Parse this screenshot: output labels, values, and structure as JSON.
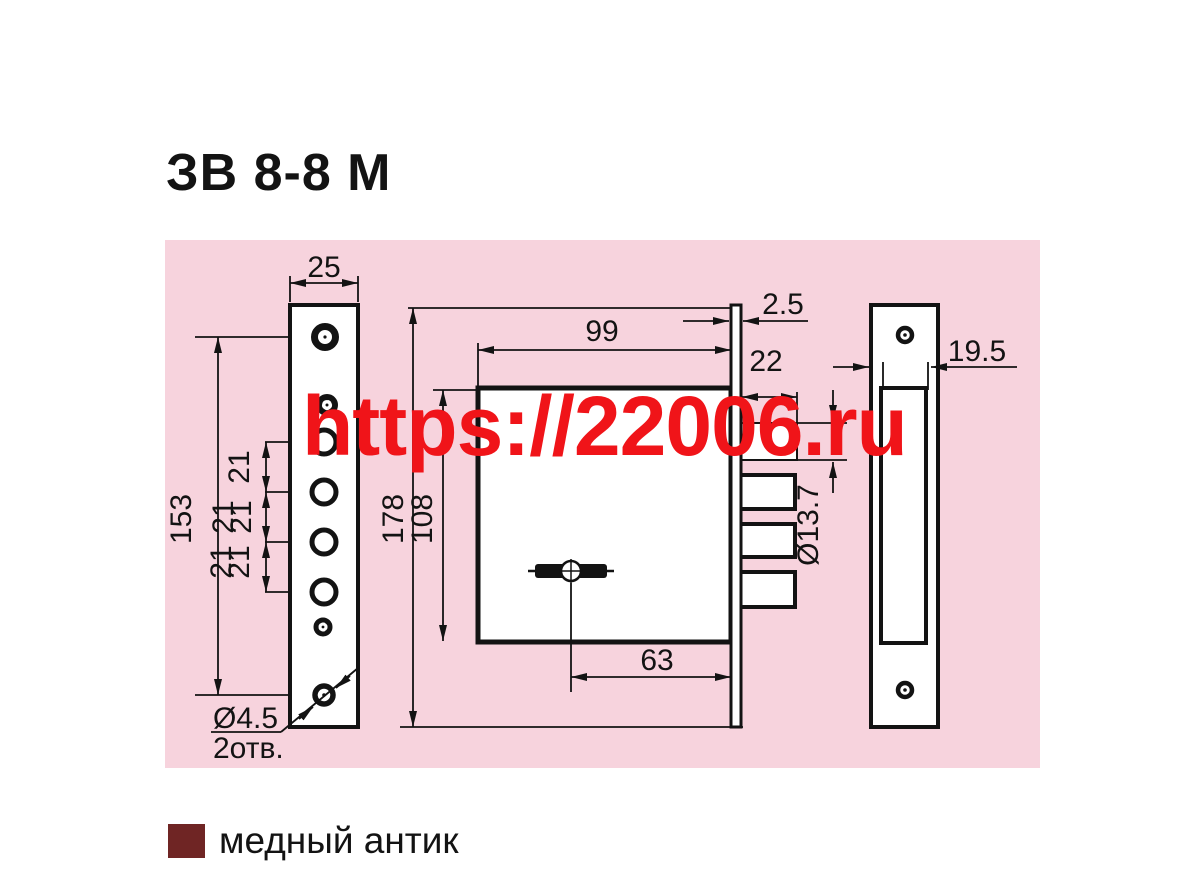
{
  "header": {
    "title": "ЗВ 8-8 М"
  },
  "watermark": {
    "text": "https://22006.ru",
    "color": "#f01419"
  },
  "drawing": {
    "panel_bg": "#f7d3dd",
    "line_color": "#131313",
    "dims": {
      "plate_width": "25",
      "plate_hole_span": "153",
      "pitch": [
        "21",
        "21",
        "21",
        "21",
        "21"
      ],
      "screw_hole_dia": "Ø4.5",
      "screw_hole_count": "2отв.",
      "body_width": "99",
      "face_thickness": "2.5",
      "bolt_throw": "22",
      "bolt_dia": "Ø13.7",
      "face_height": "178",
      "body_height": "108",
      "backset": "63",
      "strike_width": "19.5"
    }
  },
  "legend": {
    "swatch_color": "#6f2524",
    "label": "медный антик"
  }
}
